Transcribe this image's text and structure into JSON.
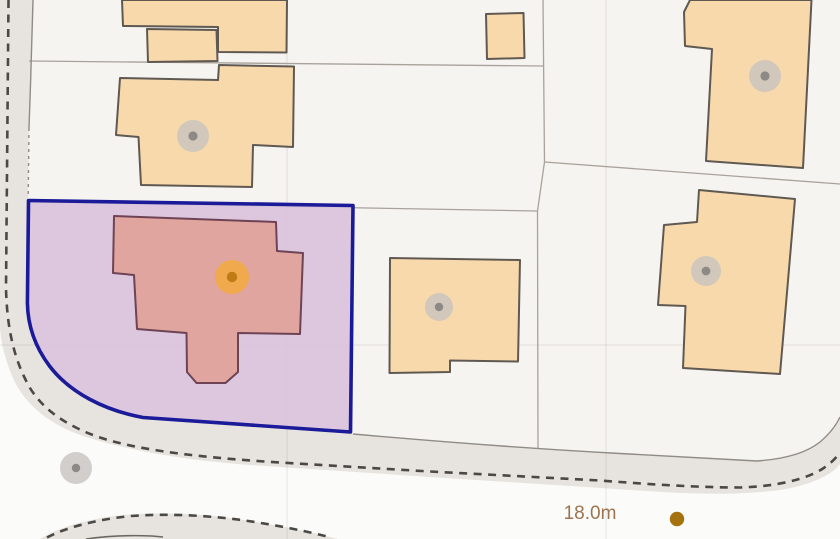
{
  "map": {
    "kind": "cadastral parcel map with highlighted corner plot",
    "measurement": {
      "label": "18.0m"
    },
    "selected_parcel": {
      "description": "corner plot outlined in blue",
      "fill": "#d9c2dc",
      "stroke": "#1b1b99"
    },
    "selected_building": {
      "description": "house footprint highlighted in red",
      "fill": "#e0a59e",
      "stroke": "#6e4355",
      "marker_halo": "#f1a945",
      "marker_center": "#bf7c15"
    },
    "colors": {
      "parcel_background": "#f6f4f0",
      "outer_background": "#fbfbf9",
      "road_fill": "#e7e3df",
      "boundary_dash": "#4b4946",
      "road_edge": "#8f8b85",
      "parcel_line": "#a8a29a",
      "building_fill": "#f8d9ab",
      "building_stroke": "#5f5952",
      "marker_fill": "#c7c3bf",
      "marker_center": "#8d8a86",
      "measure_text": "#9c7450",
      "measure_dot": "#a6720e"
    },
    "markers": {
      "building_marker_count": 4,
      "road_marker_count": 1,
      "selected_building_marker_count": 1,
      "measure_dot_count": 1
    }
  }
}
